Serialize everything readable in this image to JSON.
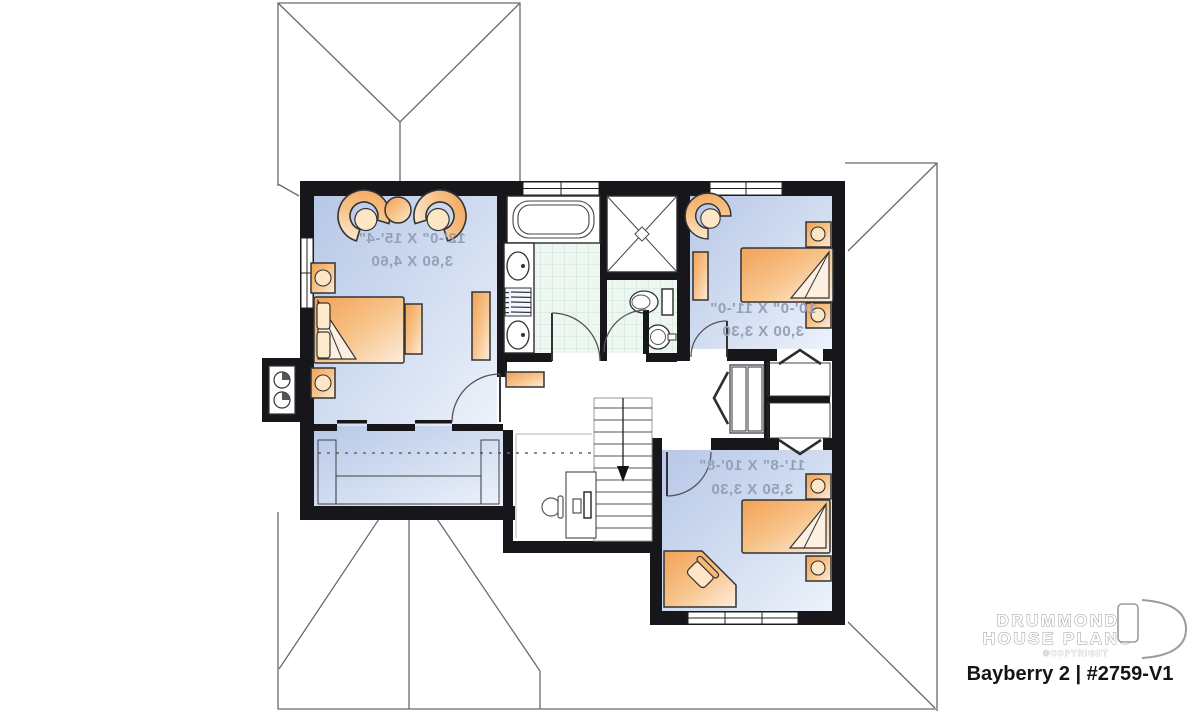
{
  "plan": {
    "rooms": [
      {
        "id": "master-bedroom",
        "imperial": "12'-0\" X 15'-4\"",
        "metric": "3,60 X 4,60"
      },
      {
        "id": "bedroom-2",
        "imperial": "10'-0\" X 11'-0\"",
        "metric": "3,00 X 3,30"
      },
      {
        "id": "bedroom-3",
        "imperial": "11'-8\" X 10'-8\"",
        "metric": "3,50 X 3,30"
      }
    ],
    "symbols": {
      "stairs": "down-arrow",
      "closet_doors": "bifold-chevron",
      "chimney": "double-flue"
    },
    "colors": {
      "wall": "#17171b",
      "floor_blue_dark": "#b7c7e7",
      "floor_blue_light": "#edf2fb",
      "furniture_orange": "#f2a155",
      "furniture_cream": "#fceddc",
      "tile": "#eef6f1",
      "tile_line": "#cde4d6",
      "dimension_text": "#93a0b8",
      "roof_line": "#6a6a6a"
    }
  },
  "branding": {
    "name_line1": "DRUMMOND",
    "name_line2": "HOUSE PLANS",
    "copyright": "©COPYRIGHT",
    "plan_title": "Bayberry 2 | #2759-V1"
  }
}
